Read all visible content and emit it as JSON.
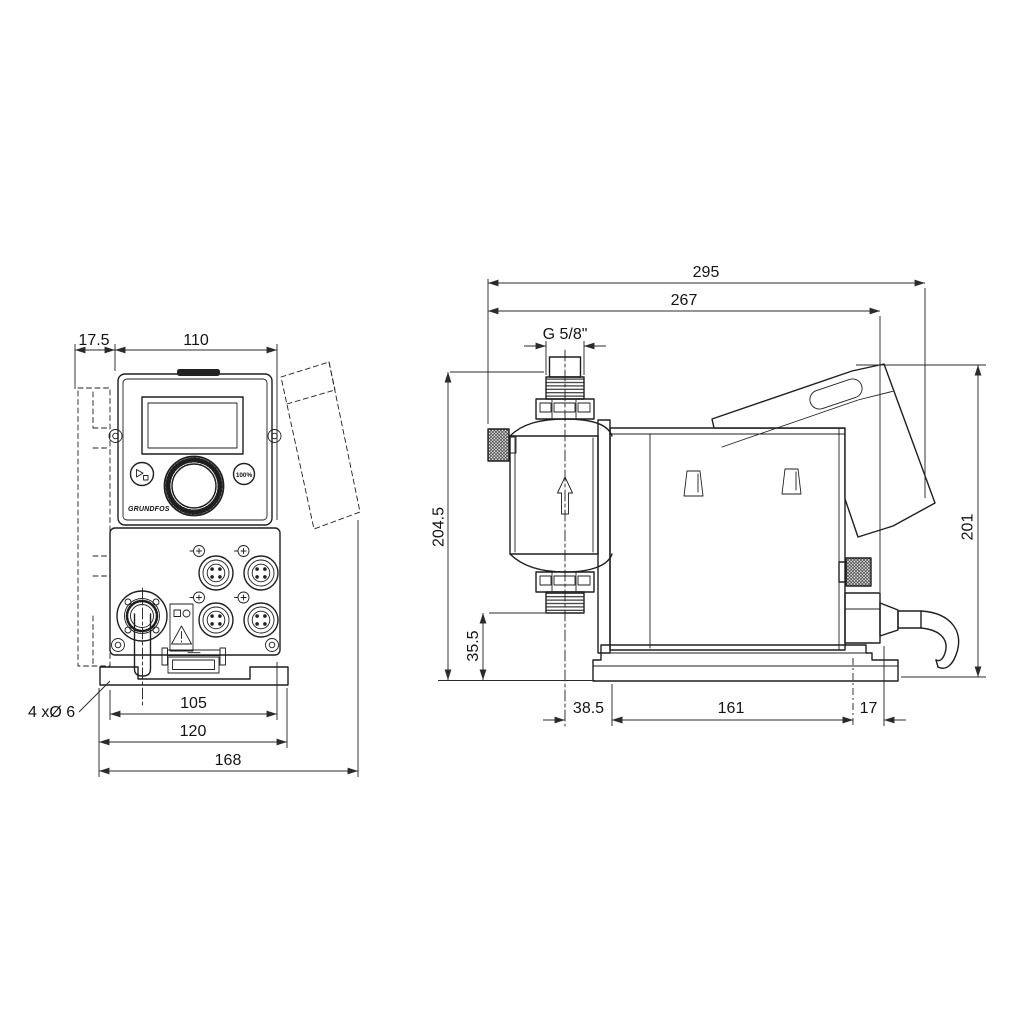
{
  "drawing_colors": {
    "line": "#1f1f1f",
    "background": "#ffffff"
  },
  "front_view": {
    "dimensions": {
      "wall_clearance": "17.5",
      "housing_width": "110",
      "mount_hole_spacing": "105",
      "mount_plate_width": "120",
      "overall_width": "168"
    },
    "mount_holes_label": "4 xØ 6",
    "control_panel": {
      "percent_button": "100%",
      "logo": "GRUNDFOS"
    }
  },
  "side_view": {
    "dimensions": {
      "overall_depth": "295",
      "depth_to_connector": "267",
      "connection_thread": "G 5/8\"",
      "overall_height": "204.5",
      "suction_valve_height": "35.5",
      "valve_center_offset": "38.5",
      "baseplate_depth": "161",
      "connector_overhang": "17",
      "rear_height": "201"
    }
  },
  "icons": [
    "start-stop-icon",
    "warning-triangle-icon",
    "flow-direction-arrow-icon",
    "m12-connector-icon",
    "grundfos-logo"
  ]
}
